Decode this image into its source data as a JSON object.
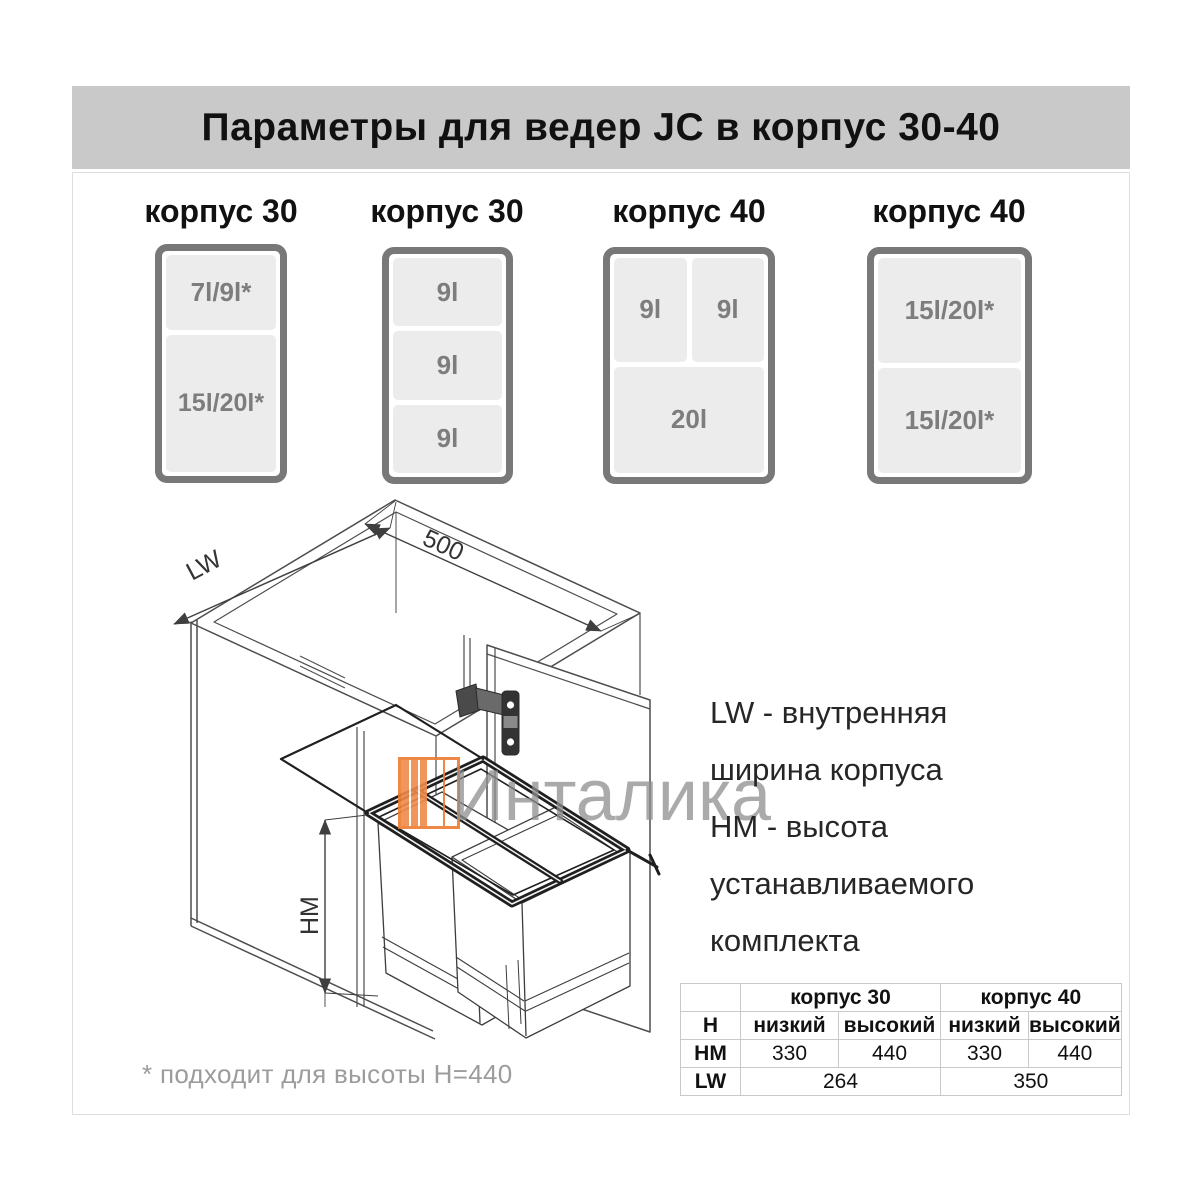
{
  "header": {
    "title": "Параметры для ведер JC в корпус 30-40"
  },
  "diagrams": [
    {
      "title": "корпус 30",
      "cells": [
        "7l/9l*",
        "15l/20l*"
      ]
    },
    {
      "title": "корпус 30",
      "cells": [
        "9l",
        "9l",
        "9l"
      ]
    },
    {
      "title": "корпус 40",
      "cells": [
        "9l",
        "9l",
        "20l"
      ]
    },
    {
      "title": "корпус 40",
      "cells": [
        "15l/20l*",
        "15l/20l*"
      ]
    }
  ],
  "drawing": {
    "width_label": "LW",
    "depth_label": "500",
    "height_label": "HM"
  },
  "legend": {
    "lines": [
      "LW - внутренняя",
      "ширина корпуса",
      "HM - высота",
      "устанавливаемого",
      "комплекта"
    ]
  },
  "watermark": {
    "text": "Инталика",
    "accent_color": "#ed7d31",
    "text_color": "#8e8e8e"
  },
  "spec_table": {
    "col_groups": [
      "корпус 30",
      "корпус 40"
    ],
    "rows": [
      {
        "label": "H",
        "values": [
          "низкий",
          "высокий",
          "низкий",
          "высокий"
        ]
      },
      {
        "label": "HM",
        "values": [
          "330",
          "440",
          "330",
          "440"
        ]
      },
      {
        "label": "LW",
        "values": [
          "264",
          "350"
        ]
      }
    ]
  },
  "footnote": "* подходит для высоты H=440",
  "colors": {
    "header_bar": "#c9c9c9",
    "box_border": "#787878",
    "cell_fill": "#ececec",
    "cell_text": "#7d7d7d",
    "accent_orange": "#ed7d31"
  }
}
